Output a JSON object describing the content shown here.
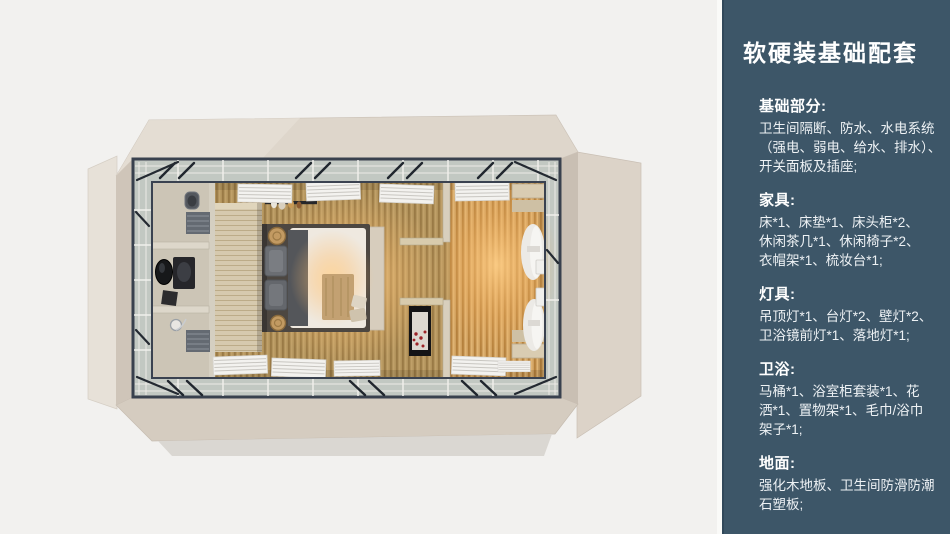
{
  "slide": {
    "background": "#f2f1ef"
  },
  "sidebar": {
    "background": "#3d5668",
    "title": "软硬装基础配套",
    "sections": [
      {
        "heading": "基础部分:",
        "lines": [
          "卫生间隔断、防水、水电系统",
          "（强电、弱电、给水、排水）、",
          "开关面板及插座;"
        ]
      },
      {
        "heading": "家具:",
        "lines": [
          "床*1、床垫*1、床头柜*2、",
          "休闲茶几*1、休闲椅子*2、",
          "衣帽架*1、梳妆台*1;"
        ]
      },
      {
        "heading": "灯具:",
        "lines": [
          "吊顶灯*1、台灯*2、壁灯*2、",
          "卫浴镜前灯*1、落地灯*1;"
        ]
      },
      {
        "heading": "卫浴:",
        "lines": [
          "马桶*1、浴室柜套装*1、花",
          "洒*1、置物架*1、毛巾/浴巾",
          "架子*1;"
        ]
      },
      {
        "heading": "地面:",
        "lines": [
          "强化木地板、卫生间防滑防潮",
          "石塑板;"
        ]
      }
    ]
  },
  "floorplan": {
    "palette": {
      "outer_walls": "#ded6cb",
      "metal_frame": "#39414e",
      "glass": "#c2c8c2",
      "bedroom_wood_floor": "#b2935c",
      "lounge_wood_floor": "#cfa05f",
      "warm_light_glow": "#ffc071",
      "bathroom_floor": "#ccc5b6",
      "wardrobe_wood": "#d6c9ae",
      "bed_linen": "#efe9e0"
    }
  }
}
